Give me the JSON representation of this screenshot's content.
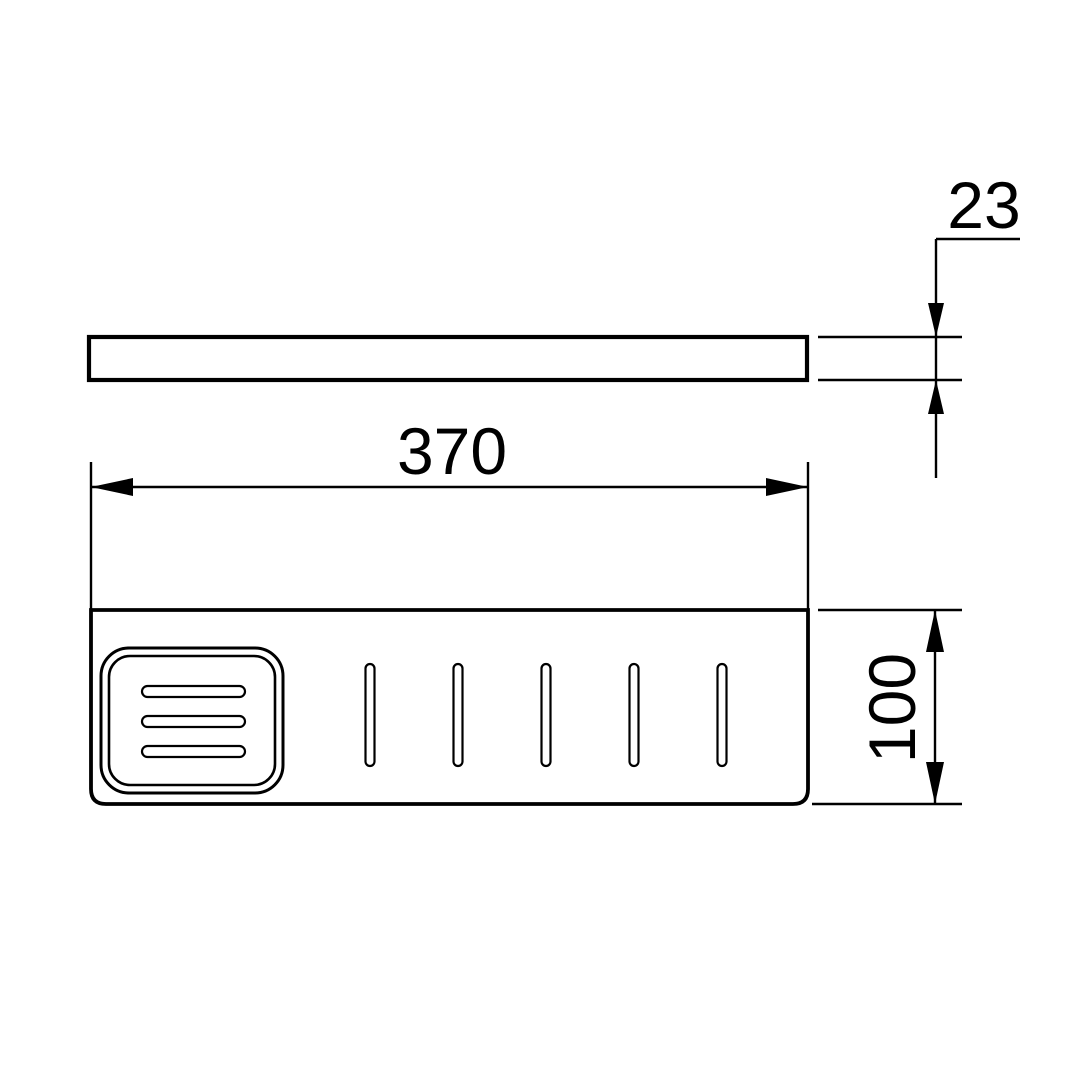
{
  "page": {
    "background_color": "#ffffff",
    "line_color": "#000000"
  },
  "drawing": {
    "type": "technical-dimension-drawing",
    "views": {
      "side_view": "thin horizontal bar (shelf edge profile)",
      "top_view": "shelf plan with soap dish recess and drain slots"
    },
    "dimensions": {
      "thickness": "23",
      "width": "370",
      "depth": "100"
    }
  }
}
